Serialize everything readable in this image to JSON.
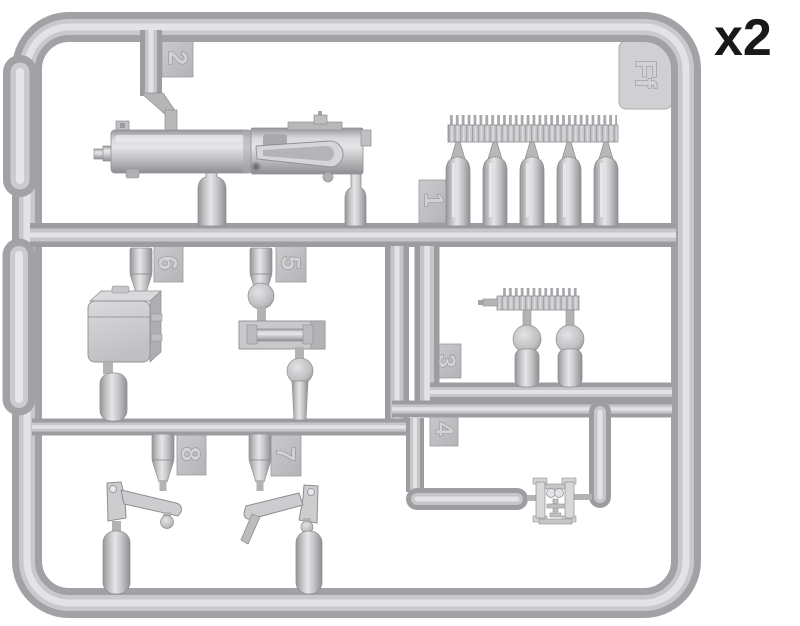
{
  "sprue": {
    "multiplier": "x2",
    "letter": "Ff",
    "tags": {
      "t1": "1",
      "t2": "2",
      "t3": "3",
      "t4": "4",
      "t5": "5",
      "t6": "6",
      "t7": "7",
      "t8": "8"
    }
  },
  "colors": {
    "background": "#ffffff",
    "plastic_dark": "#9d9da1",
    "plastic_mid": "#c6c6c9",
    "plastic_light": "#e3e3e5",
    "tab_fill": "#c2c2c5",
    "quantity_text": "#19191b"
  }
}
